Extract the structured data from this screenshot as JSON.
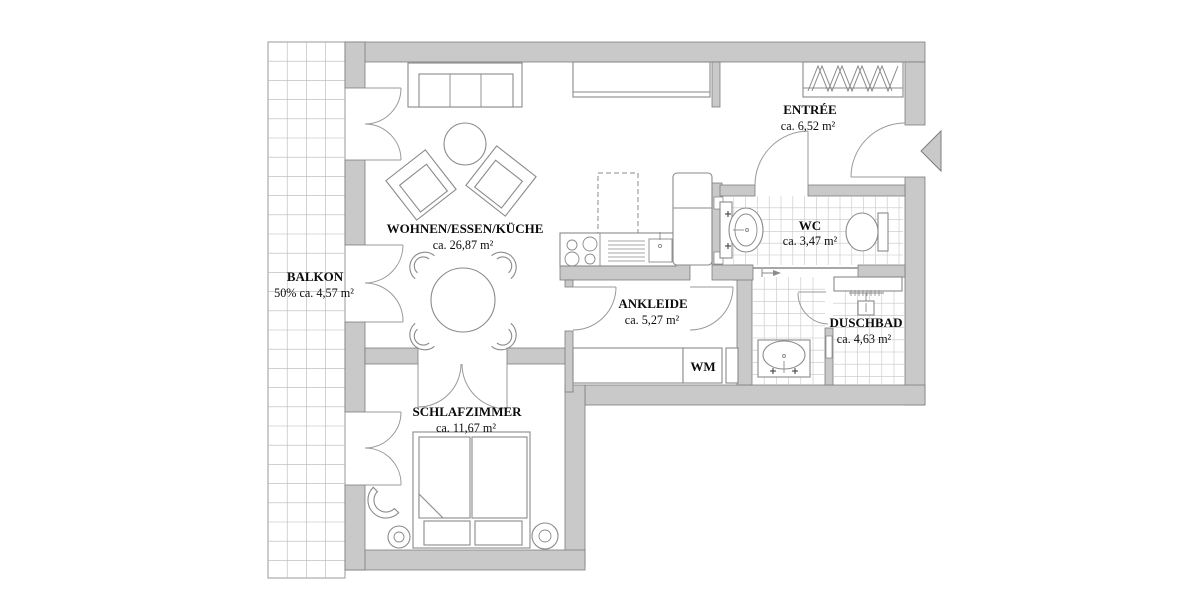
{
  "rooms": {
    "balkon": {
      "name": "BALKON",
      "area": "50% ca. 4,57 m²"
    },
    "wohnen": {
      "name": "WOHNEN/ESSEN/KÜCHE",
      "area": "ca. 26,87 m²"
    },
    "entree": {
      "name": "ENTRÉE",
      "area": "ca. 6,52 m²"
    },
    "wc": {
      "name": "WC",
      "area": "ca. 3,47 m²"
    },
    "ankleide": {
      "name": "ANKLEIDE",
      "area": "ca. 5,27 m²"
    },
    "duschbad": {
      "name": "DUSCHBAD",
      "area": "ca. 4,63 m²"
    },
    "schlafzimmer": {
      "name": "SCHLAFZIMMER",
      "area": "ca. 11,67 m²"
    }
  },
  "labels": {
    "washing_machine": "WM"
  },
  "colors": {
    "wall": "#c9c9ca",
    "wall_stroke": "#7e7e7e",
    "furniture_line": "#8a8a8a",
    "tile_line": "#c6c6c6",
    "text": "#0b0b0b",
    "background": "#ffffff"
  }
}
